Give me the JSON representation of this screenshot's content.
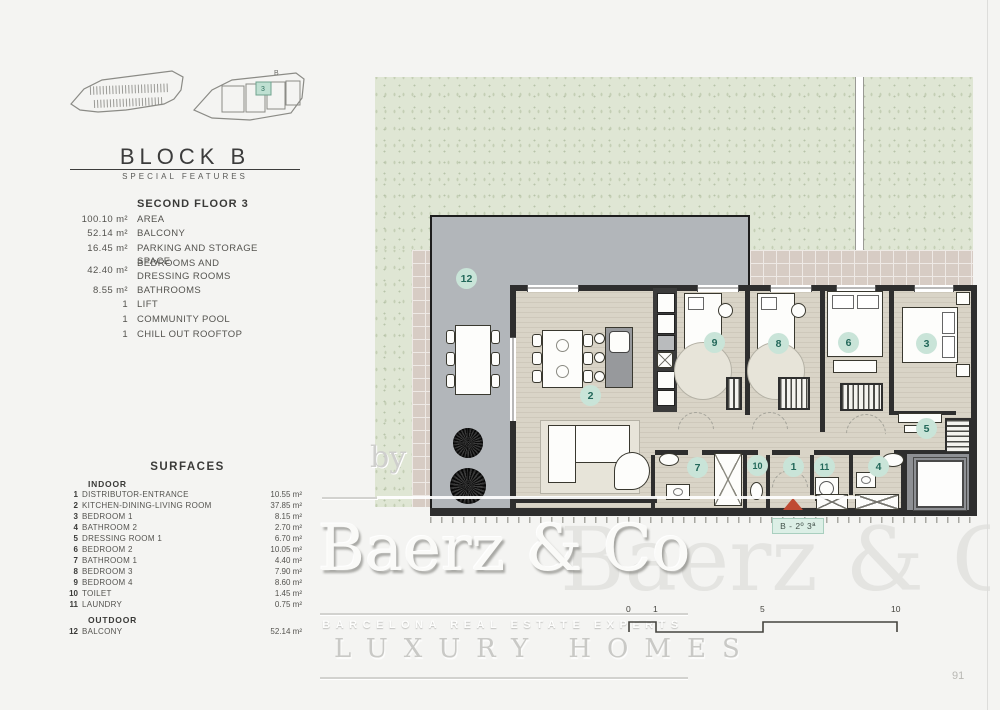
{
  "header": {
    "block_title": "BLOCK B",
    "block_subtitle": "SPECIAL FEATURES",
    "diagram_b_label": "B",
    "diagram_unit_label": "3"
  },
  "floor_section": {
    "title": "SECOND FLOOR 3",
    "features": [
      {
        "value": "100.10 m²",
        "label": "AREA"
      },
      {
        "value": "52.14 m²",
        "label": "BALCONY"
      },
      {
        "value": "16.45 m²",
        "label": "PARKING AND STORAGE SPACE"
      },
      {
        "value": "42.40 m²",
        "label": "BEDROOMS AND DRESSING ROOMS"
      },
      {
        "value": "8.55 m²",
        "label": "BATHROOMS"
      },
      {
        "value": "1",
        "label": "LIFT"
      },
      {
        "value": "1",
        "label": "COMMUNITY POOL"
      },
      {
        "value": "1",
        "label": "CHILL OUT ROOFTOP"
      }
    ]
  },
  "surfaces": {
    "title": "SURFACES",
    "indoor_heading": "INDOOR",
    "outdoor_heading": "OUTDOOR",
    "indoor": [
      {
        "num": "1",
        "label": "DISTRIBUTOR-ENTRANCE",
        "value": "10.55 m²"
      },
      {
        "num": "2",
        "label": "KITCHEN-DINING-LIVING ROOM",
        "value": "37.85 m²"
      },
      {
        "num": "3",
        "label": "BEDROOM 1",
        "value": "8.15 m²"
      },
      {
        "num": "4",
        "label": "BATHROOM 2",
        "value": "2.70 m²"
      },
      {
        "num": "5",
        "label": "DRESSING ROOM 1",
        "value": "6.70 m²"
      },
      {
        "num": "6",
        "label": "BEDROOM 2",
        "value": "10.05 m²"
      },
      {
        "num": "7",
        "label": "BATHROOM 1",
        "value": "4.40 m²"
      },
      {
        "num": "8",
        "label": "BEDROOM 3",
        "value": "7.90 m²"
      },
      {
        "num": "9",
        "label": "BEDROOM 4",
        "value": "8.60 m²"
      },
      {
        "num": "10",
        "label": "TOILET",
        "value": "1.45 m²"
      },
      {
        "num": "11",
        "label": "LAUNDRY",
        "value": "0.75 m²"
      }
    ],
    "outdoor": [
      {
        "num": "12",
        "label": "BALCONY",
        "value": "52.14 m²"
      }
    ]
  },
  "plan": {
    "unit_label": "B - 2º 3ª",
    "badges": [
      {
        "num": "1",
        "room": "distributor-entrance"
      },
      {
        "num": "2",
        "room": "kitchen-dining-living-room"
      },
      {
        "num": "3",
        "room": "bedroom-1"
      },
      {
        "num": "4",
        "room": "bathroom-2"
      },
      {
        "num": "5",
        "room": "dressing-room-1"
      },
      {
        "num": "6",
        "room": "bedroom-2"
      },
      {
        "num": "7",
        "room": "bathroom-1"
      },
      {
        "num": "8",
        "room": "bedroom-3"
      },
      {
        "num": "9",
        "room": "bedroom-4"
      },
      {
        "num": "10",
        "room": "toilet"
      },
      {
        "num": "11",
        "room": "laundry"
      },
      {
        "num": "12",
        "room": "balcony"
      }
    ],
    "scale_ticks": [
      "0",
      "1",
      "5",
      "10"
    ]
  },
  "watermark": {
    "by": "by",
    "brand": "Baerz & Co",
    "tagline": "BARCELONA REAL ESTATE EXPERTS",
    "subtitle": "LUXURY HOMES"
  },
  "page": {
    "number": "91"
  },
  "colors": {
    "badge_bg": "#c9e4d8",
    "badge_text": "#23685a",
    "garden": "#dfe6d4",
    "tile": "#d7ccc4",
    "balcony": "#b2b6ba",
    "floor": "#d9d4c7",
    "wall": "#2e2e2e",
    "entrance_marker": "#bf4a33",
    "unit_label_bg": "#dcefe6"
  }
}
